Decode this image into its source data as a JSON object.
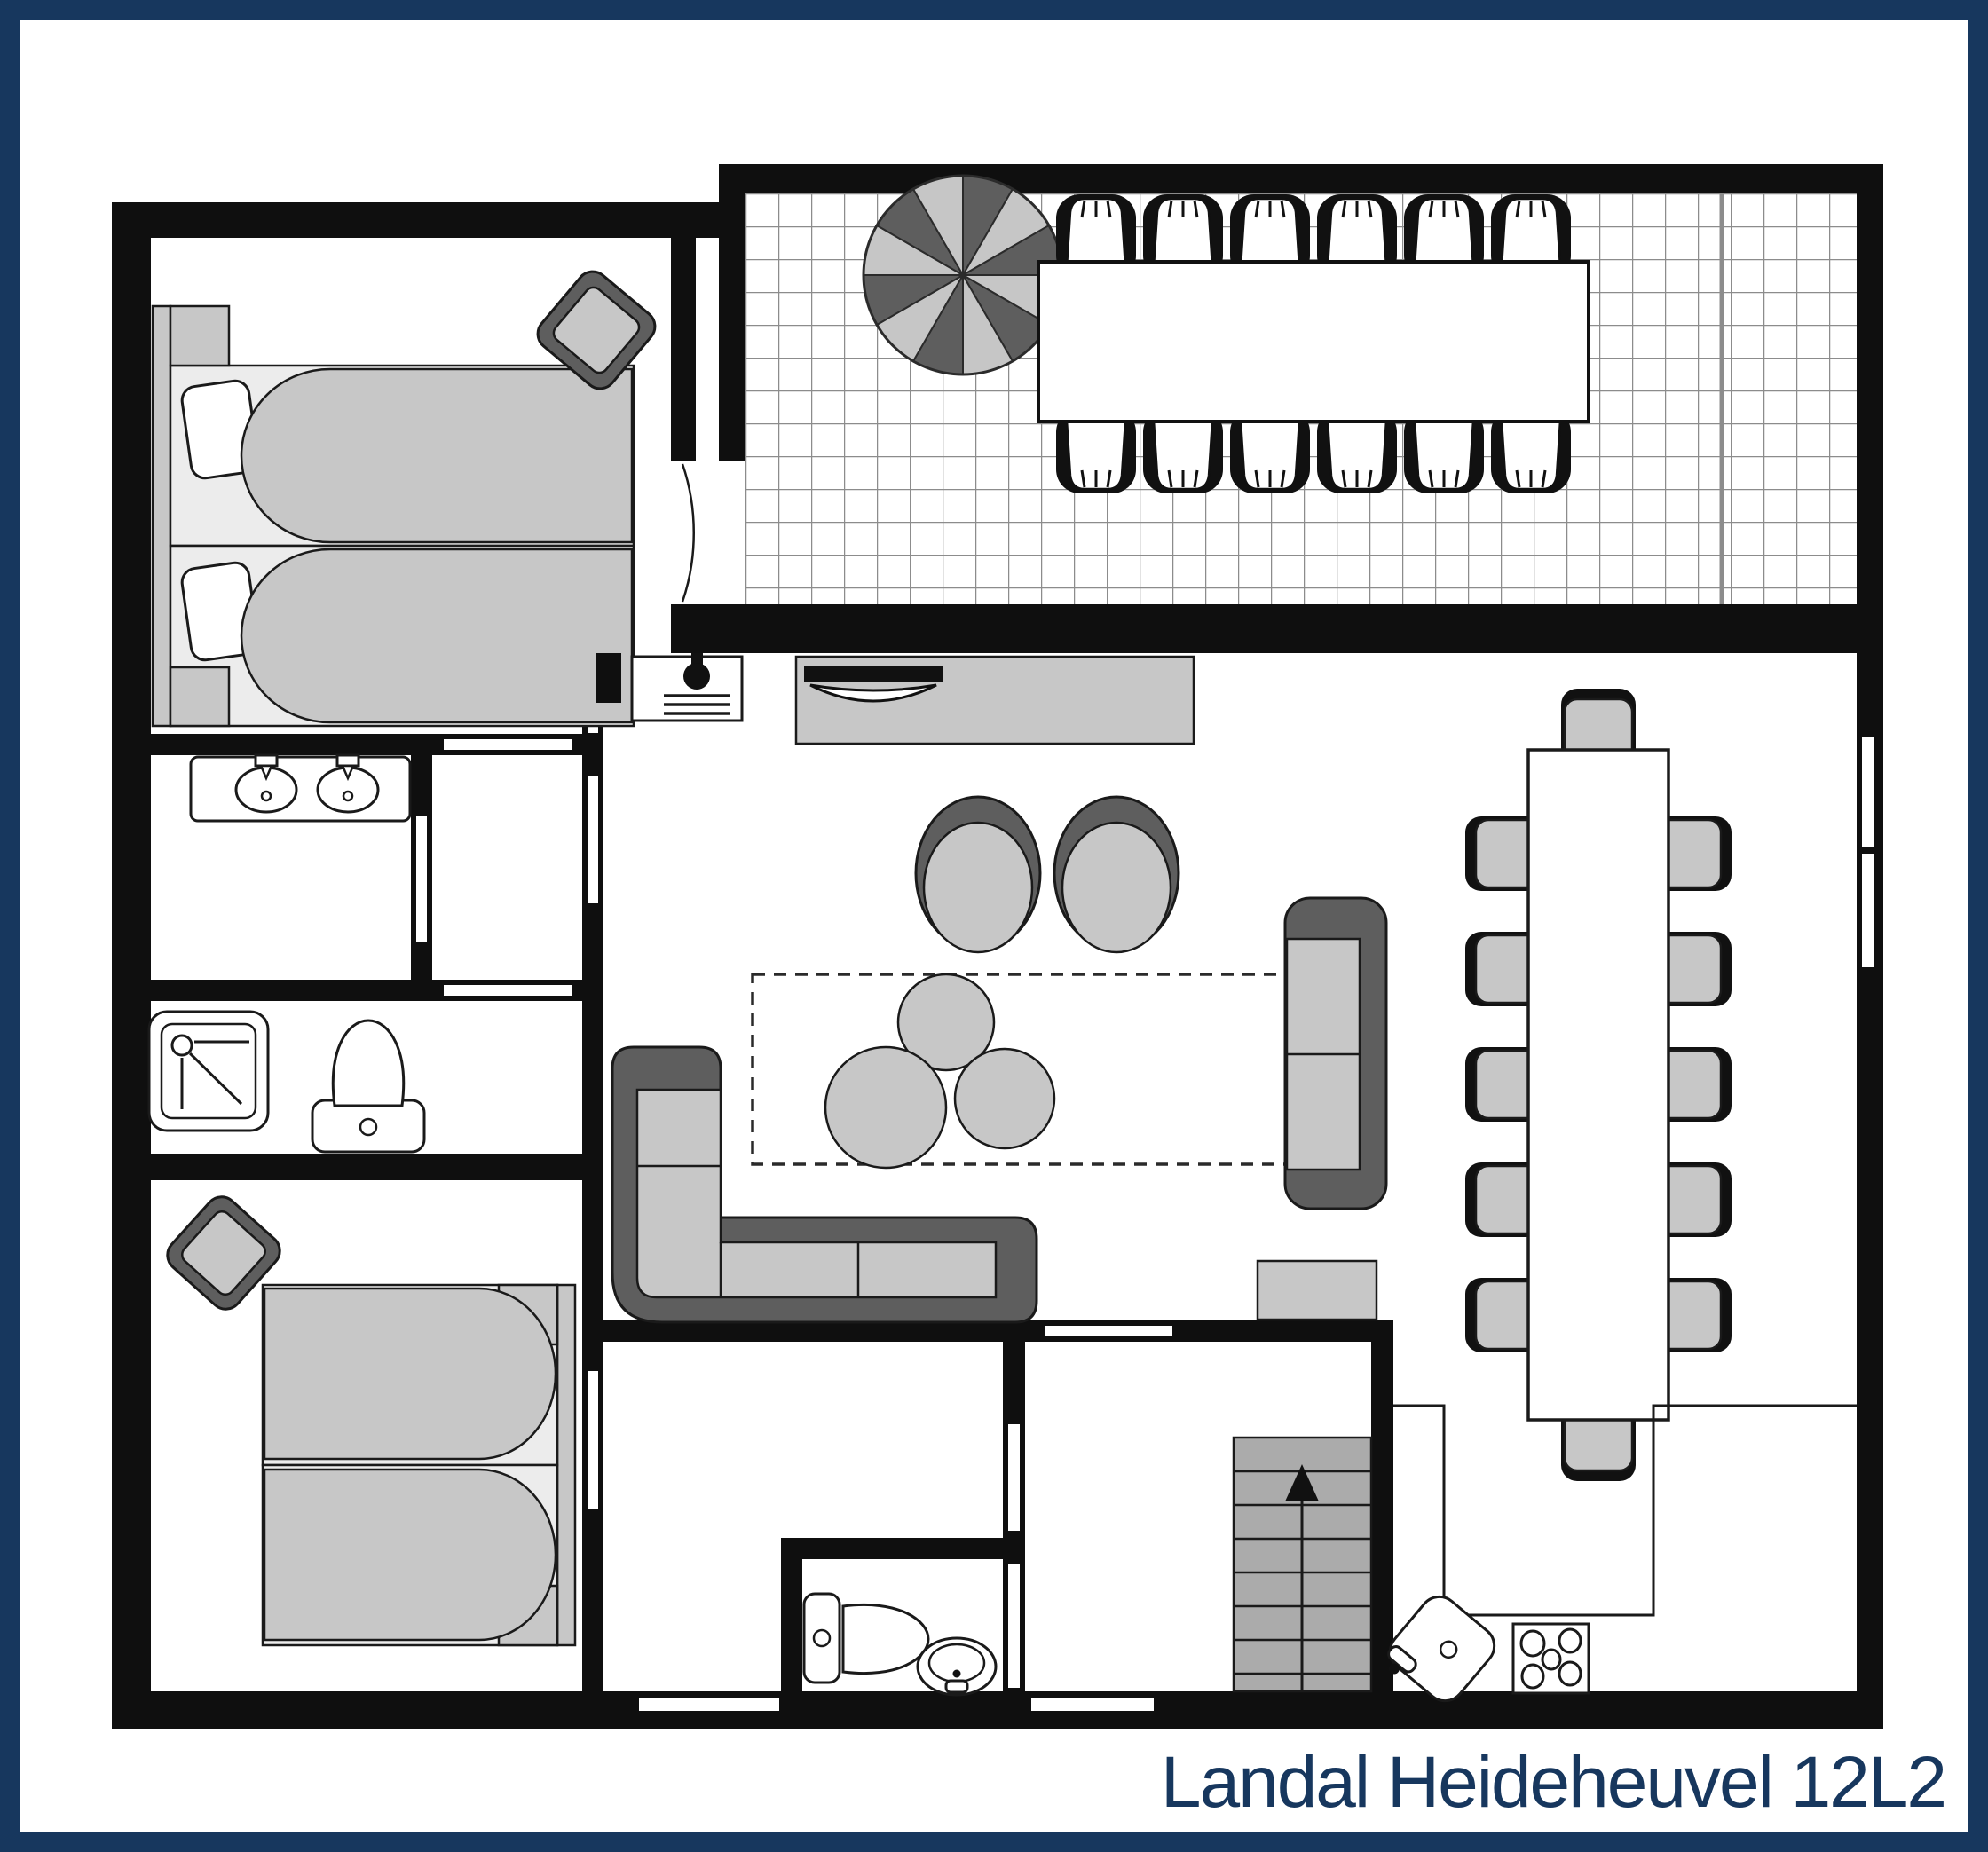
{
  "title": "Landal Heideheuvel 12L2",
  "colors": {
    "navy": "#17375e",
    "wall": "#0f0f0f",
    "ink": "#1a1a1a",
    "grayLight": "#c7c7c7",
    "grayMid": "#ababab",
    "grayDark": "#5e5e5e",
    "grayBase": "#ececec",
    "gridLine": "#8c8c8c"
  },
  "plan": {
    "type": "floor-plan",
    "terrace": {
      "parasol_segments": 12,
      "table_seats": 12,
      "tiled": true
    },
    "dining_room": {
      "table_seats": 12
    },
    "bedrooms": [
      {
        "bed": "double",
        "position": "top-left",
        "pouf": true
      },
      {
        "bed": "double",
        "position": "bottom-left",
        "pouf": true
      }
    ],
    "bathroom": {
      "sinks": 2,
      "shower": true,
      "toilets": 2
    },
    "kitchen": {
      "hob_burners": 4,
      "sink": true
    },
    "stairs": {
      "direction": "up",
      "steps": 8
    },
    "living_room": {
      "sofas": 2,
      "armchairs": 2,
      "coffee_tables": 3,
      "tv": true,
      "fireplace": true
    }
  }
}
